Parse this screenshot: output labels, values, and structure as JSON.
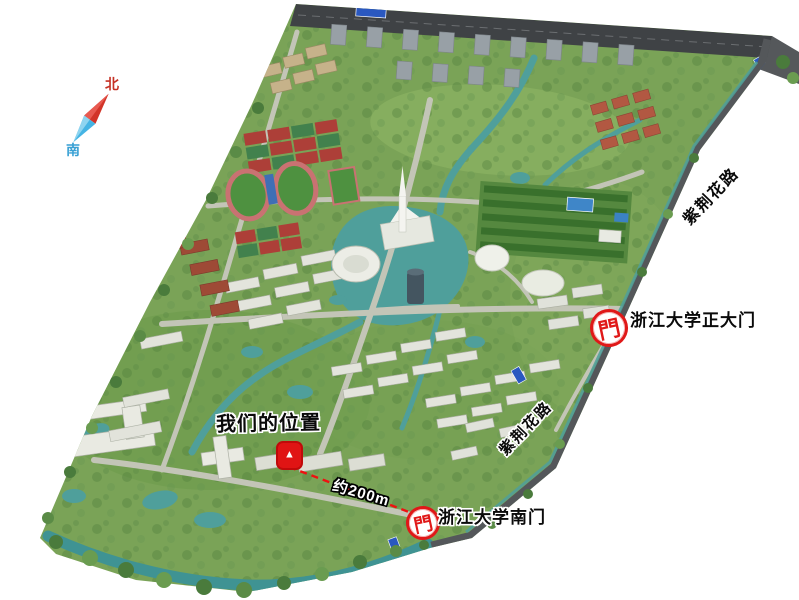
{
  "page": {
    "background": "#ffffff"
  },
  "compass": {
    "north": "北",
    "south": "南"
  },
  "labels": {
    "our_position": "我们的位置",
    "scale_distance": "约200m",
    "south_gate": "浙江大学南门",
    "main_gate": "浙江大学正大门",
    "road_upper": "紫荆花路",
    "road_lower": "紫荆花路"
  },
  "icons": {
    "gate_glyph": "門",
    "pin_glyph": "▲"
  },
  "colors": {
    "annotation_red": "#ee1111",
    "compass_north_red": "#d23428",
    "compass_south_blue": "#45b4e4",
    "water_teal": "#4f9f9b",
    "grass_green": "#7aa357",
    "highway_dark": "#3f4245"
  }
}
